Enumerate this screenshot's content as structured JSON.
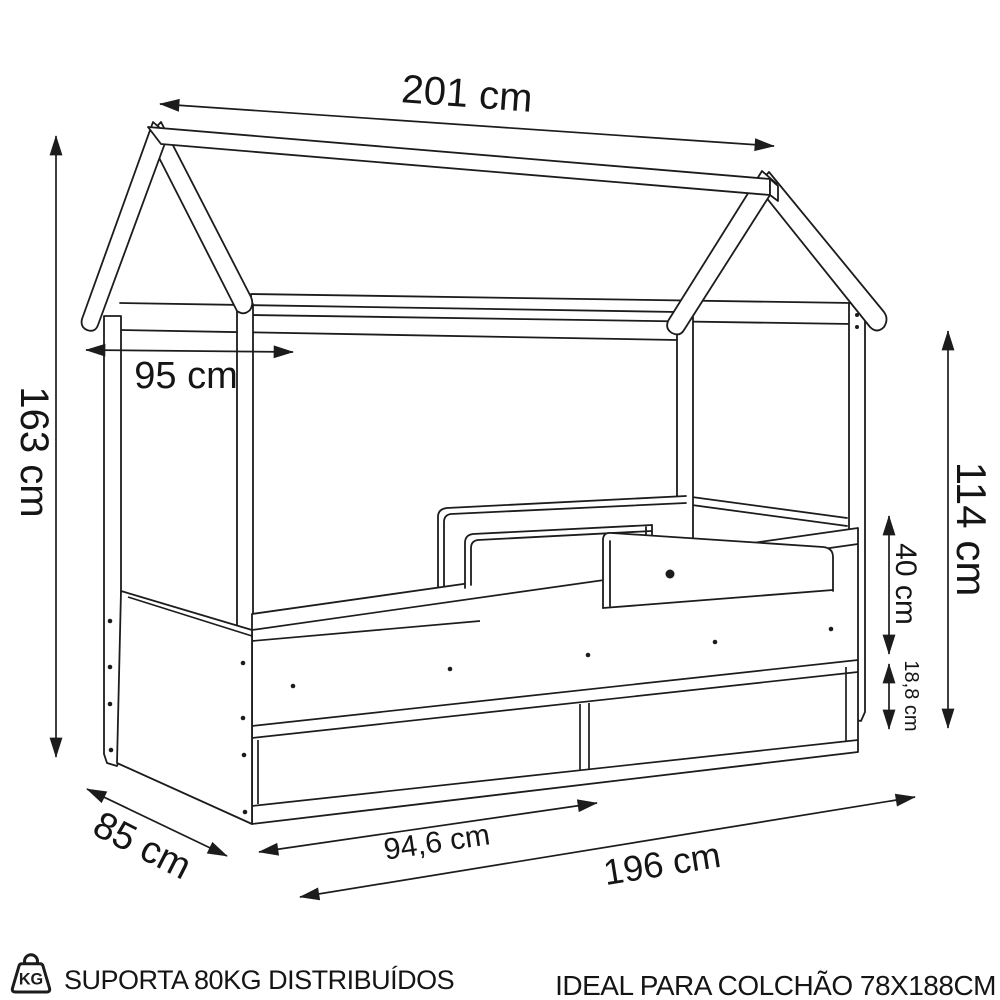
{
  "diagram_title": "house bed technical drawing",
  "dims": {
    "total_width": "201 cm",
    "roof_depth": "95 cm",
    "total_height": "163 cm",
    "canopy_height": "114 cm",
    "rail_height": "40 cm",
    "drawer_height": "18,8 cm",
    "bed_depth": "85 cm",
    "drawer_width": "94,6 cm",
    "bed_length": "196 cm"
  },
  "footer": {
    "weight_badge": "KG",
    "capacity_text": "SUPORTA 80KG DISTRIBUÍDOS",
    "mattress_text": "IDEAL PARA COLCHÃO 78X188CM"
  },
  "colors": {
    "line": "#1c1c1c",
    "background": "#ffffff",
    "text": "#151515"
  }
}
